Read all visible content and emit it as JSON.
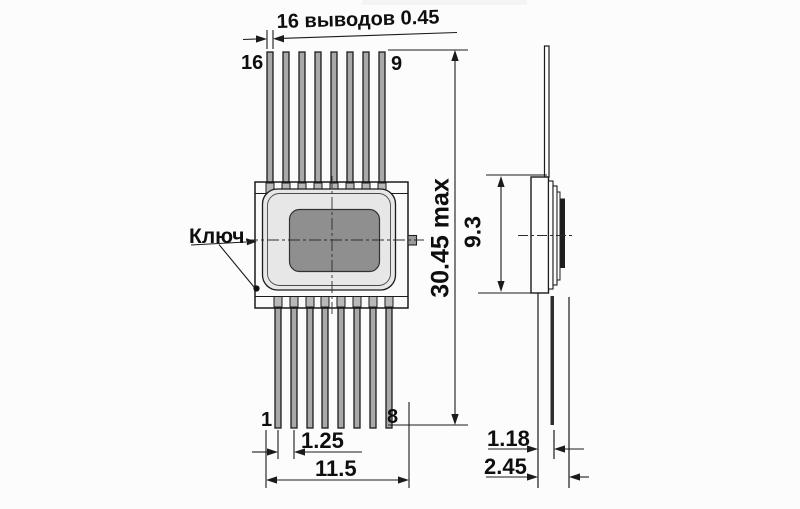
{
  "annotations": {
    "lead_note": "16 выводов 0.45",
    "key_label": "Ключ"
  },
  "pin_numbers": {
    "top_left": "16",
    "top_right": "9",
    "bottom_left": "1",
    "bottom_right": "8"
  },
  "dimensions": {
    "overall_length": "30.45 max",
    "side_body_height": "9.3",
    "lead_pitch": "1.25",
    "lead_span": "11.5",
    "lead_plane_inner": "1.18",
    "lead_plane_outer": "2.45"
  },
  "colors": {
    "line": "#1b1b1b",
    "body_fill": "#e7e7e7",
    "lid_fill": "#8f8f8f",
    "side_lid_fill": "#1e1e1e",
    "background": "#fcfcfc"
  }
}
